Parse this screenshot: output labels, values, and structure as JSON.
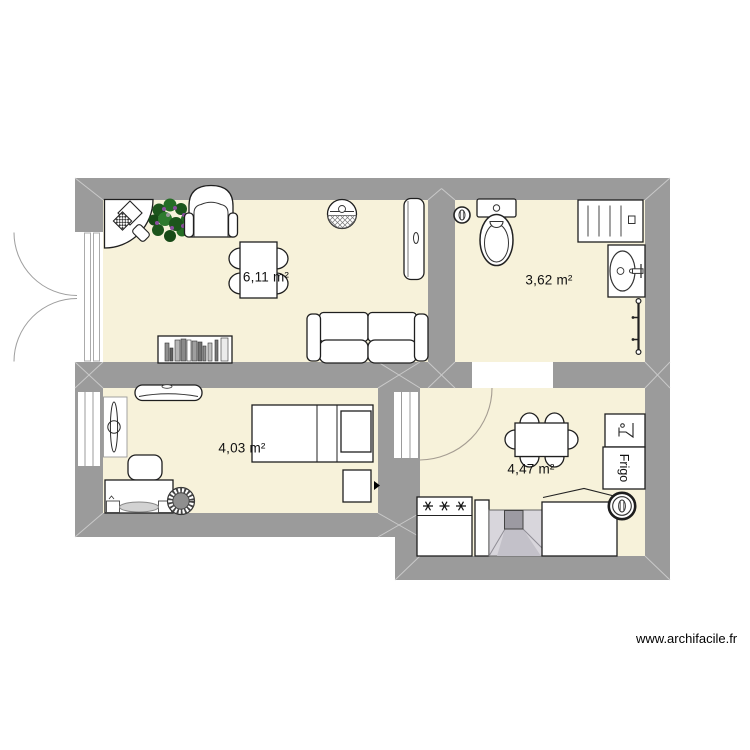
{
  "watermark": "www.archifacile.fr",
  "rooms": [
    {
      "name": "living-room",
      "area_label": "6,11 m²"
    },
    {
      "name": "bathroom",
      "area_label": "3,62 m²"
    },
    {
      "name": "bedroom",
      "area_label": "4,03 m²"
    },
    {
      "name": "kitchen",
      "area_label": "4,47 m²"
    }
  ],
  "labels": {
    "fridge": "Frigo"
  },
  "colors": {
    "wall": "#9b9b9b",
    "floor": "#f7f2da",
    "outline": "#1f1f1f",
    "miter": "#c9c9c9",
    "fireplace_body": "#d8d6dc",
    "fireplace_flue": "#9c9aa2"
  },
  "furniture": {
    "living_room": [
      "corner-desk-with-computer",
      "potted-plant",
      "armchair",
      "pendant-lamp",
      "wall-radiator",
      "dining-table",
      "chair",
      "chair",
      "chair",
      "chair",
      "bookshelf",
      "sofa"
    ],
    "bathroom": [
      "spot-light",
      "toilet",
      "radiator",
      "washbasin",
      "towel-rail"
    ],
    "bedroom": [
      "air-conditioner",
      "ironing-board",
      "pouf",
      "dressing-table",
      "wicker-stool",
      "single-bed",
      "nightstand",
      "power-outlet"
    ],
    "kitchen": [
      "door-swing",
      "dining-table",
      "chair",
      "chair",
      "chair",
      "chair",
      "chair",
      "chair",
      "bar-cabinet",
      "fridge",
      "stove",
      "base-cabinet",
      "fireplace",
      "chest-appliance-open-lid",
      "spot-light"
    ]
  }
}
